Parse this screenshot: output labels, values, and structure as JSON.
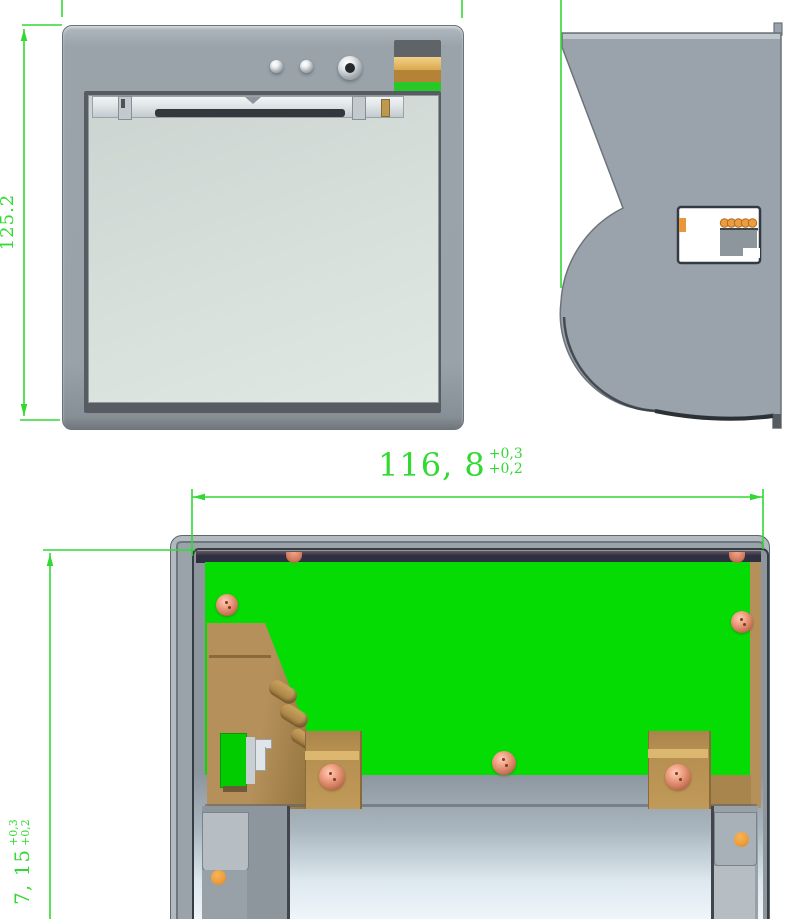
{
  "drawing": {
    "dimensions": {
      "front_height": {
        "value": "125.2"
      },
      "opening_width": {
        "value": "116, 8",
        "tol_upper": "+0,3",
        "tol_lower": "+0,2"
      },
      "opening_depth": {
        "value": "7, 15",
        "tol_upper": "+0,3",
        "tol_lower": "+0,2"
      }
    },
    "colors": {
      "dimension_green": "#32d932",
      "pcb_green": "#04dc04",
      "body_gray": "#9aa2aa",
      "door_gray": "#d6ded9",
      "brass": "#b5905a",
      "copper_screw": "#cf7a5c",
      "gold_connector": "#d9a94e",
      "orange_marker": "#f0a13c"
    }
  }
}
